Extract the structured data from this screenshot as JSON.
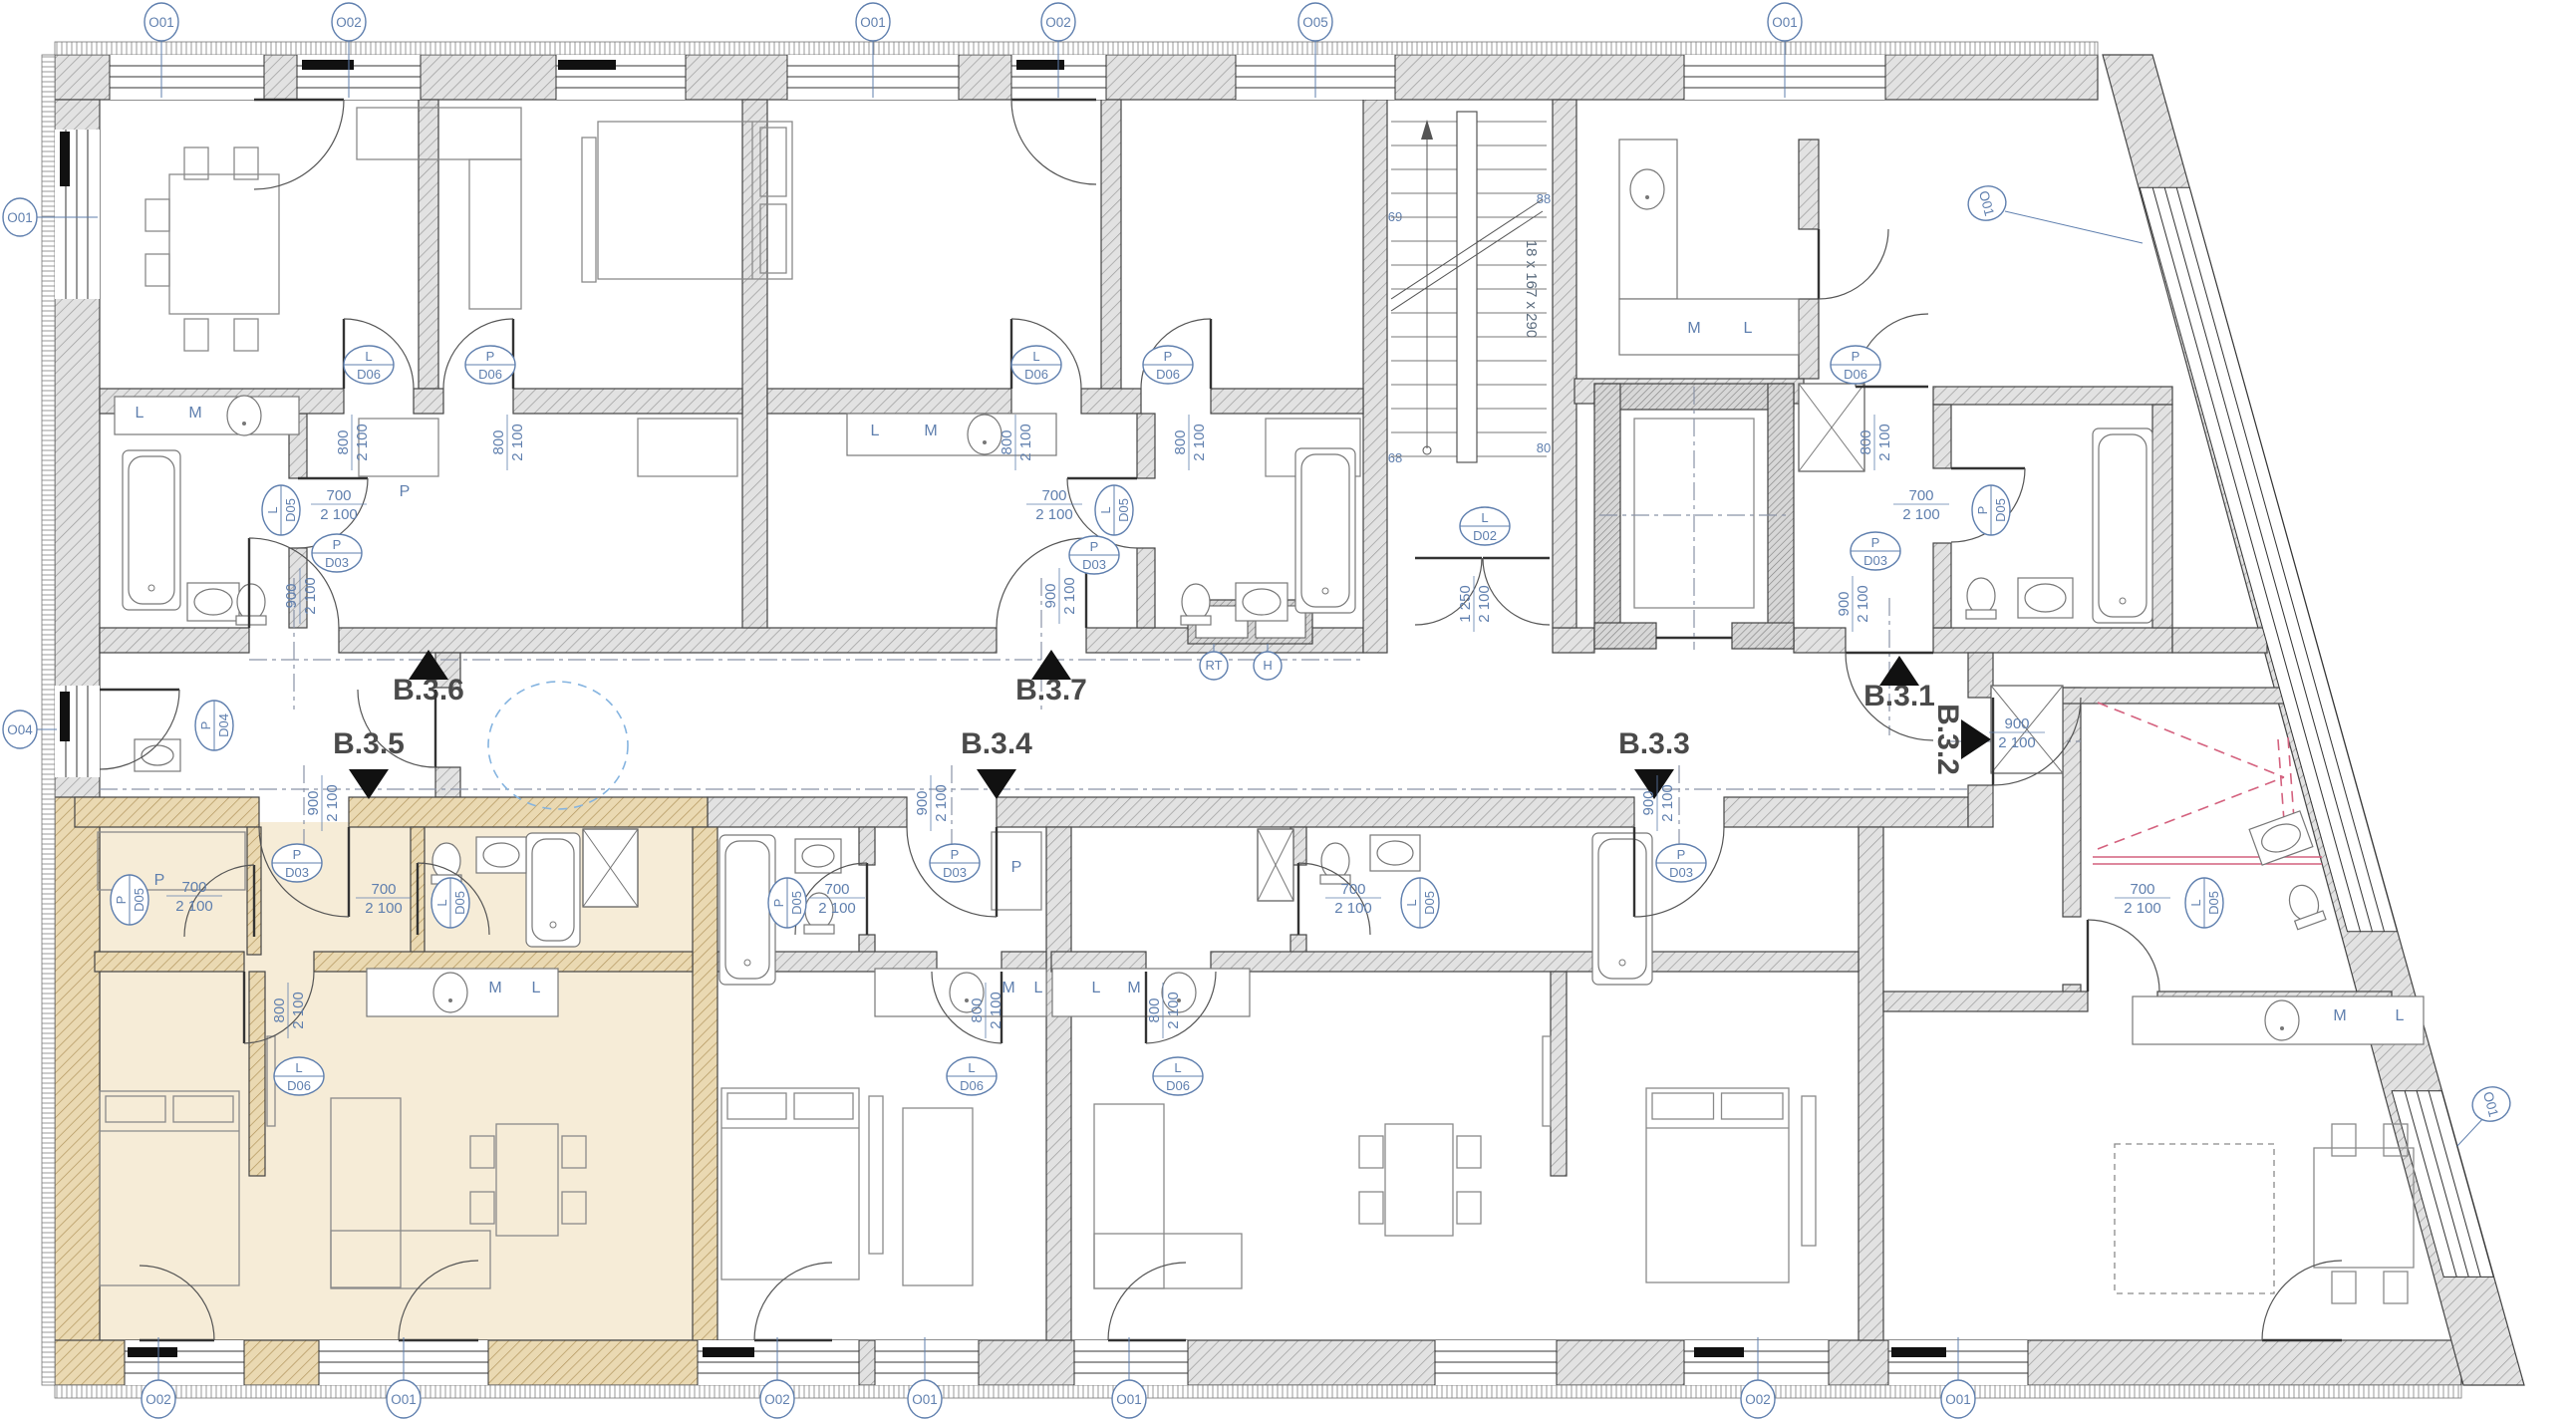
{
  "plan": {
    "type": "Residential floor plan",
    "highlighted_unit": "B.3.5",
    "colors": {
      "highlight_fill": "#f6ecd7",
      "highlight_wall": "#ead9b2",
      "annotation_blue": "#5f7fae",
      "marker_black": "#111111",
      "shower_red": "#d4617e",
      "wall_grey": "#e2e2e2"
    }
  },
  "apartments": [
    {
      "id": "B.3.1",
      "entry_direction": "up",
      "highlighted": false
    },
    {
      "id": "B.3.2",
      "entry_direction": "right",
      "highlighted": false
    },
    {
      "id": "B.3.3",
      "entry_direction": "down",
      "highlighted": false
    },
    {
      "id": "B.3.4",
      "entry_direction": "down",
      "highlighted": false
    },
    {
      "id": "B.3.5",
      "entry_direction": "down",
      "highlighted": true
    },
    {
      "id": "B.3.6",
      "entry_direction": "up",
      "highlighted": false
    },
    {
      "id": "B.3.7",
      "entry_direction": "up",
      "highlighted": false
    }
  ],
  "grid_markers": {
    "top": [
      "O01",
      "O02",
      "O01",
      "O02",
      "O05",
      "O01"
    ],
    "bottom": [
      "O02",
      "O01",
      "O02",
      "O01",
      "O01",
      "O02",
      "O01"
    ],
    "left": [
      "O01",
      "O04"
    ],
    "slanted_wall": [
      "O01",
      "O01"
    ]
  },
  "doors": [
    {
      "leaf": "L",
      "code": "D05",
      "width": "700",
      "height": "2 100"
    },
    {
      "leaf": "P",
      "code": "D03",
      "width": "900",
      "height": "2 100"
    },
    {
      "leaf": "L",
      "code": "D06",
      "width": "800",
      "height": "2 100"
    },
    {
      "leaf": "P",
      "code": "D06",
      "width": "800",
      "height": "2 100"
    },
    {
      "leaf": "L",
      "code": "D06",
      "width": "800",
      "height": "2 100"
    },
    {
      "leaf": "P",
      "code": "D06",
      "width": "800",
      "height": "2 100"
    },
    {
      "leaf": "L",
      "code": "D05",
      "width": "700",
      "height": "2 100"
    },
    {
      "leaf": "P",
      "code": "D03",
      "width": "900",
      "height": "2 100"
    },
    {
      "leaf": "P",
      "code": "D06",
      "width": "800",
      "height": "2 100"
    },
    {
      "leaf": "P",
      "code": "D05",
      "width": "700",
      "height": "2 100"
    },
    {
      "leaf": "P",
      "code": "D03",
      "width": "900",
      "height": "2 100"
    },
    {
      "leaf": "P",
      "code": "D04",
      "width": "",
      "height": ""
    },
    {
      "leaf": "L",
      "code": "D02",
      "width": "1 250",
      "height": "2 100"
    },
    {
      "leaf": "P",
      "code": "D05",
      "width": "700",
      "height": "2 100"
    },
    {
      "leaf": "P",
      "code": "D03",
      "width": "900",
      "height": "2 100"
    },
    {
      "leaf": "L",
      "code": "D05",
      "width": "700",
      "height": "2 100"
    },
    {
      "leaf": "L",
      "code": "D06",
      "width": "800",
      "height": "2 100"
    },
    {
      "leaf": "P",
      "code": "D05",
      "width": "700",
      "height": "2 100"
    },
    {
      "leaf": "P",
      "code": "D03",
      "width": "900",
      "height": "2 100"
    },
    {
      "leaf": "L",
      "code": "D06",
      "width": "800",
      "height": "2 100"
    },
    {
      "leaf": "P",
      "code": "D03",
      "width": "900",
      "height": "2 100"
    },
    {
      "leaf": "L",
      "code": "D05",
      "width": "700",
      "height": "2 100"
    },
    {
      "leaf": "L",
      "code": "D06",
      "width": "800",
      "height": "2 100"
    },
    {
      "leaf": "L",
      "code": "D05",
      "width": "700",
      "height": "2 100"
    },
    {
      "leaf": "",
      "code": "",
      "width": "900",
      "height": "2 100"
    }
  ],
  "letters": {
    "P": "P",
    "M": "M",
    "L": "L"
  },
  "stairwell": {
    "run_label": "18 x 167 x 290",
    "corner_marks": [
      "69",
      "88",
      "80",
      "68"
    ]
  },
  "risers": {
    "labels": [
      "RT",
      "H"
    ]
  }
}
